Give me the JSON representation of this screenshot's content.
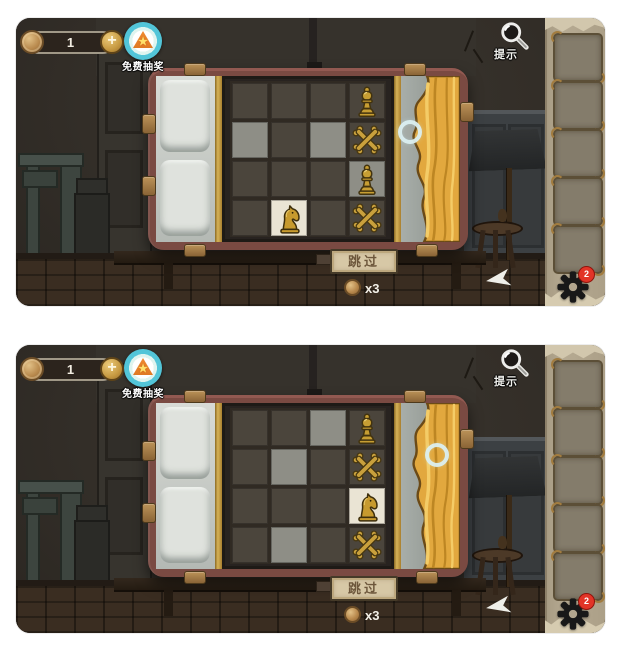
{
  "ui": {
    "coin_count": "1",
    "add_button": "+",
    "free_lottery_label": "免费抽奖",
    "hint_label": "提示",
    "skip_label": "跳过",
    "skip_cost_label": "x3",
    "settings_badge": "2",
    "star_glyph": "★"
  },
  "icons": [
    "coin-icon",
    "plus-icon",
    "free-lottery-tent-icon",
    "magnifier-icon",
    "gear-icon",
    "target-ring-cursor",
    "chess-pawn-icon",
    "chess-knight-icon",
    "crossed-bones-icon",
    "curtain",
    "inventory-arrow-icon",
    "inventory-slot"
  ],
  "colors": {
    "wall": "#332e28",
    "floor": "#3a2d21",
    "pipe_frame": "#7a4a42",
    "gold_trim": "#c6a145",
    "cell_dark": "#4b453c",
    "cell_light": "#8e8e86",
    "cell_cream": "#eae4d4",
    "piece_gold": "#c79e33",
    "curtain_gold": "#e2a83e",
    "bedding_gray": "#cbcec9",
    "parchment": "#b6aa92",
    "slot_gray": "#847c6b",
    "plaque_tan": "#d7c8a6",
    "plaque_text": "#6d573c",
    "coin_bronze": "#b98a4e",
    "badge_red": "#e23427",
    "ring_cyan": "#dcf0f2",
    "lottery_cyan": "#52c5d8",
    "lottery_orange": "#ef8a31"
  },
  "board": {
    "rows": 4,
    "cols": 4
  },
  "panels": [
    {
      "state": "knight-bottom-left",
      "cells": [
        [
          "dark",
          "dark",
          "dark",
          "dark"
        ],
        [
          "light",
          "dark",
          "light",
          "dark"
        ],
        [
          "dark",
          "dark",
          "dark",
          "light"
        ],
        [
          "dark",
          "cream",
          "dark",
          "dark"
        ]
      ],
      "pieces": [
        {
          "piece": "pawn",
          "row": 0,
          "col": 3
        },
        {
          "piece": "cross",
          "row": 1,
          "col": 3
        },
        {
          "piece": "pawn",
          "row": 2,
          "col": 3
        },
        {
          "piece": "knight",
          "row": 3,
          "col": 1
        },
        {
          "piece": "cross",
          "row": 3,
          "col": 3
        }
      ],
      "cursor": {
        "cx": 394,
        "cy": 114
      },
      "inventory_slots": 5
    },
    {
      "state": "knight-right-column",
      "cells": [
        [
          "dark",
          "dark",
          "light",
          "dark"
        ],
        [
          "dark",
          "light",
          "dark",
          "dark"
        ],
        [
          "dark",
          "dark",
          "dark",
          "cream"
        ],
        [
          "dark",
          "light",
          "dark",
          "dark"
        ]
      ],
      "pieces": [
        {
          "piece": "pawn",
          "row": 0,
          "col": 3
        },
        {
          "piece": "cross",
          "row": 1,
          "col": 3
        },
        {
          "piece": "knight",
          "row": 2,
          "col": 3
        },
        {
          "piece": "cross",
          "row": 3,
          "col": 3
        }
      ],
      "cursor": {
        "cx": 421,
        "cy": 110
      },
      "inventory_slots": 5
    }
  ]
}
